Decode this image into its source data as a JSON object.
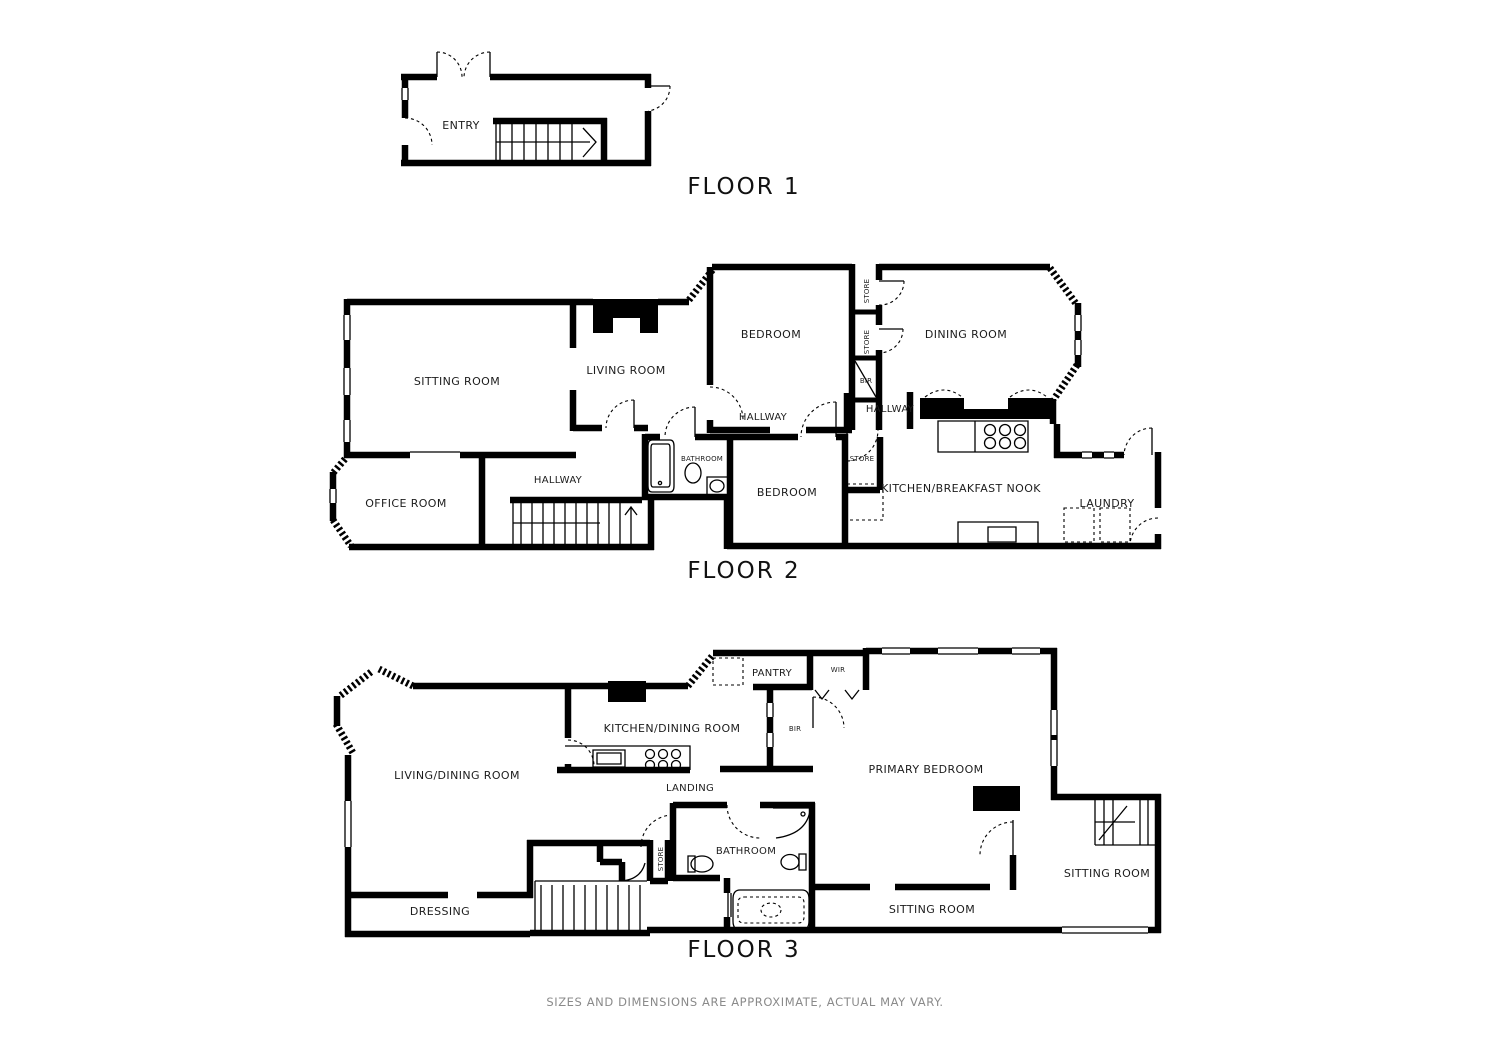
{
  "page": {
    "background": "#ffffff",
    "wall_color": "#000000",
    "footer_color": "#8a8a8a"
  },
  "floor1": {
    "title": "FLOOR 1",
    "rooms": {
      "entry": "ENTRY"
    }
  },
  "floor2": {
    "title": "FLOOR 2",
    "rooms": {
      "sitting_room": "SITTING ROOM",
      "living_room": "LIVING ROOM",
      "bedroom_top": "BEDROOM",
      "dining_room": "DINING ROOM",
      "store_upper": "STORE",
      "store_lower": "STORE",
      "bir": "BIR",
      "hallway_center": "HALLWAY",
      "hallway_right": "HALLWAY",
      "hallway_left": "HALLWAY",
      "office_room": "OFFICE ROOM",
      "bathroom": "BATHROOM",
      "bedroom_bottom": "BEDROOM",
      "store_small": "STORE",
      "kitchen": "KITCHEN/BREAKFAST NOOK",
      "laundry": "LAUNDRY"
    }
  },
  "floor3": {
    "title": "FLOOR 3",
    "rooms": {
      "living_dining": "LIVING/DINING ROOM",
      "kitchen_dining": "KITCHEN/DINING ROOM",
      "pantry": "PANTRY",
      "wir": "WIR",
      "bir": "BIR",
      "landing": "LANDING",
      "primary_bedroom": "PRIMARY BEDROOM",
      "store": "STORE",
      "bathroom": "BATHROOM",
      "dressing": "DRESSING",
      "sitting_room_center": "SITTING ROOM",
      "sitting_room_right": "SITTING ROOM"
    }
  },
  "footer": {
    "disclaimer": "SIZES AND DIMENSIONS ARE APPROXIMATE, ACTUAL MAY VARY."
  }
}
